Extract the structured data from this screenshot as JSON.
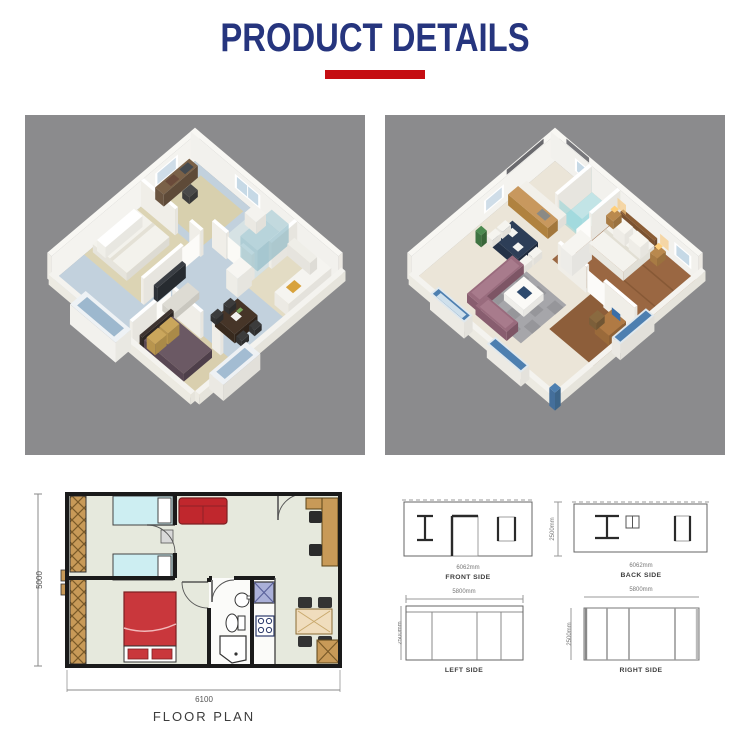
{
  "header": {
    "title": "PRODUCT DETAILS"
  },
  "colors": {
    "title_navy": "#26357e",
    "accent_red": "#c50d12",
    "panel_gray": "#8b8b8d"
  },
  "floor_plan": {
    "height_dim": "5000",
    "width_dim": "6100",
    "caption": "FLOOR PLAN"
  },
  "elevations": {
    "height_dim": "2500mm",
    "front": {
      "width_dim": "6062mm",
      "caption": "FRONT SIDE"
    },
    "back": {
      "width_dim": "6062mm",
      "caption": "BACK SIDE"
    },
    "left": {
      "width_dim": "5800mm",
      "caption": "LEFT SIDE"
    },
    "right": {
      "width_dim": "5800mm",
      "caption": "RIGHT SIDE"
    }
  }
}
